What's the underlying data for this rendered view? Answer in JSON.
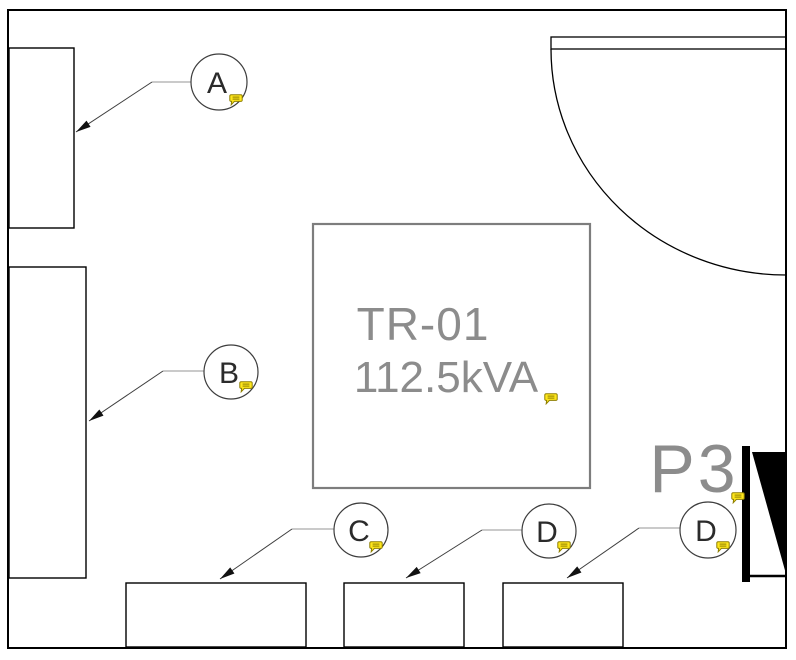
{
  "drawing": {
    "equipment": {
      "transformer_tag": "TR-01",
      "transformer_rating": "112.5kVA",
      "panel_label": "P3"
    },
    "callouts": [
      {
        "label": "A"
      },
      {
        "label": "B"
      },
      {
        "label": "C"
      },
      {
        "label": "D"
      },
      {
        "label": "D"
      }
    ],
    "annotations": {
      "comment_icon": "comment-bubble-icon",
      "comment_count": 7
    },
    "colors": {
      "line_black": "#000000",
      "equipment_gray": "#7d7d7d",
      "label_gray": "#8c8c8c",
      "leader_dark": "#3d3d3d",
      "leader_light": "#b9b9b9",
      "annotation_yellow_fill": "#ffe71c",
      "annotation_yellow_stroke": "#8f7f00"
    }
  }
}
